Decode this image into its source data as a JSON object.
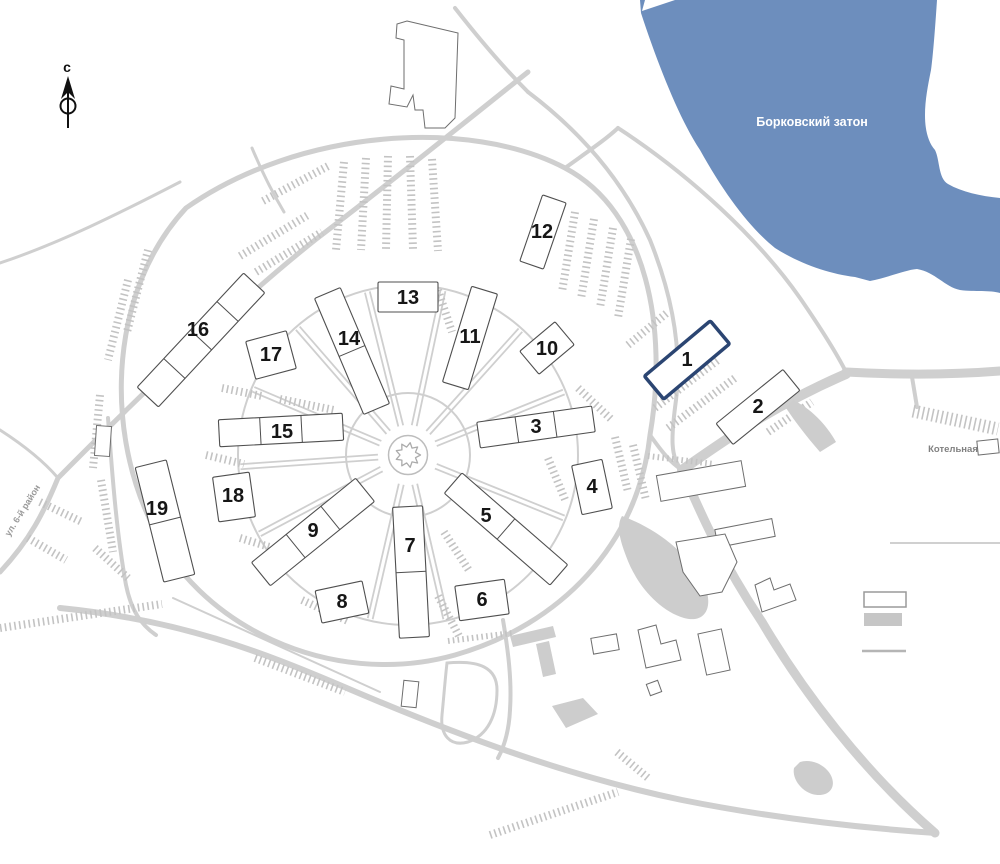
{
  "map": {
    "colors": {
      "water": "#6d8ebd",
      "road": "#cfcfcf",
      "comb": "#c3c3c3",
      "area": "#cdcdcd",
      "outline": "#6e6e6e",
      "highlight": "#2b4572",
      "number": "#161616"
    },
    "water": {
      "label": "Борковский затон",
      "path": "M 640,0 L 937,0 C 935,30 933,55 931,70 C 928,85 925,100 925,115 C 925,130 928,142 935,150 C 940,160 938,178 948,184 C 962,192 980,196 1000,198 L 1000,293 C 990,290 975,292 960,290 C 945,287 935,272 917,269 C 905,270 890,277 870,281 L 855,277 C 830,274 800,264 775,248 C 750,228 725,195 700,150 C 680,120 658,65 641,13 Z",
      "notch": "645,0 675,0 642,11"
    },
    "compass": {
      "letter": "с"
    },
    "labels": {
      "boiler": {
        "text": "Котельная"
      },
      "street": {
        "text": "ул. 6-й район"
      }
    },
    "roads": [
      {
        "d": "M 186,208 C 300,128 470,118 565,168 C 648,212 668,330 650,435 C 638,545 560,625 455,655 C 330,690 195,625 150,520 C 105,425 110,290 186,208 Z",
        "w": 5
      },
      {
        "d": "M 0,572 C 30,540 44,512 58,478 C 150,385 240,300 315,240 C 390,183 465,122 528,72",
        "w": 5
      },
      {
        "d": "M 252,148 C 262,172 272,192 284,212",
        "w": 3
      },
      {
        "d": "M 455,8 C 480,40 504,68 528,92",
        "w": 4
      },
      {
        "d": "M 528,92 C 585,135 625,185 650,240 C 672,295 682,350 676,400 C 671,437 670,458 682,470",
        "w": 4
      },
      {
        "d": "M 618,128 C 690,175 758,238 800,298 C 822,330 836,352 846,372",
        "w": 4
      },
      {
        "d": "M 565,168 C 590,150 605,140 618,128",
        "w": 4
      },
      {
        "d": "M 846,372 C 900,375 950,375 1000,371",
        "w": 9
      },
      {
        "d": "M 912,377 L 917,407",
        "w": 4
      },
      {
        "d": "M 682,470 C 722,442 772,406 846,374",
        "w": 10
      },
      {
        "d": "M 682,470 C 700,512 722,562 762,622 C 802,690 862,770 935,833",
        "w": 9
      },
      {
        "d": "M 60,608 C 180,620 262,652 342,686 C 452,733 562,775 682,800 C 772,818 862,828 936,833",
        "w": 6
      },
      {
        "d": "M 0,430 C 28,448 46,464 58,478",
        "w": 3
      },
      {
        "d": "M 108,418 C 112,470 116,530 126,585 C 131,610 141,625 156,635",
        "w": 4
      },
      {
        "d": "M 0,263 C 60,243 120,213 180,182",
        "w": 3
      },
      {
        "d": "M 650,435 C 662,452 670,462 682,470",
        "w": 4
      },
      {
        "d": "M 503,620 C 508,650 512,680 510,710 C 509,730 505,745 498,758",
        "w": 4
      },
      {
        "d": "M 447,663 C 480,660 497,668 497,690 C 497,715 488,735 468,742 C 450,747 440,735 442,715 C 444,695 445,680 447,663 Z",
        "w": 3
      },
      {
        "d": "M 173,598 C 240,628 310,660 380,692",
        "w": 2
      }
    ],
    "rings": [
      {
        "cx": 408,
        "cy": 455,
        "r": 170,
        "w": 2
      },
      {
        "cx": 408,
        "cy": 455,
        "r": 62,
        "w": 2
      }
    ],
    "spokes": {
      "cx": 408,
      "cy": 455,
      "r0": 30,
      "r1": 168,
      "offset": 2.5,
      "angles": [
        -48,
        -78,
        -104,
        -131,
        -157,
        176,
        152,
        103,
        77,
        22,
        -22
      ]
    },
    "roundabout": {
      "cx": 408,
      "cy": 455,
      "r": 19.5,
      "teeth": 9,
      "r_out": 12.5,
      "r_in": 8
    },
    "combs": [
      [
        344,
        162,
        336,
        250
      ],
      [
        366,
        158,
        361,
        250
      ],
      [
        388,
        156,
        386,
        249
      ],
      [
        410,
        156,
        413,
        249
      ],
      [
        432,
        159,
        438,
        251
      ],
      [
        575,
        212,
        562,
        292
      ],
      [
        594,
        219,
        581,
        299
      ],
      [
        613,
        228,
        600,
        308
      ],
      [
        631,
        239,
        618,
        318
      ],
      [
        628,
        345,
        668,
        312
      ],
      [
        655,
        408,
        718,
        360
      ],
      [
        668,
        428,
        735,
        378
      ],
      [
        768,
        432,
        812,
        402
      ],
      [
        913,
        411,
        998,
        429,
        13
      ],
      [
        128,
        280,
        108,
        360
      ],
      [
        148,
        250,
        127,
        332
      ],
      [
        100,
        395,
        93,
        468
      ],
      [
        101,
        480,
        113,
        552
      ],
      [
        0,
        628,
        162,
        604
      ],
      [
        95,
        548,
        128,
        578
      ],
      [
        448,
        641,
        512,
        633,
        6
      ],
      [
        255,
        658,
        345,
        692
      ],
      [
        490,
        835,
        618,
        792
      ],
      [
        222,
        388,
        262,
        396
      ],
      [
        280,
        399,
        334,
        410
      ],
      [
        240,
        256,
        308,
        215
      ],
      [
        256,
        272,
        322,
        232
      ],
      [
        263,
        201,
        330,
        165
      ],
      [
        240,
        538,
        286,
        552
      ],
      [
        302,
        600,
        350,
        622
      ],
      [
        444,
        532,
        470,
        572
      ],
      [
        438,
        596,
        460,
        638
      ],
      [
        548,
        458,
        566,
        502
      ],
      [
        578,
        388,
        612,
        420
      ],
      [
        615,
        437,
        628,
        492
      ],
      [
        633,
        445,
        646,
        500
      ],
      [
        648,
        456,
        714,
        464,
        6
      ],
      [
        617,
        752,
        648,
        778
      ],
      [
        40,
        502,
        82,
        522
      ],
      [
        28,
        538,
        66,
        560
      ],
      [
        206,
        455,
        244,
        464
      ],
      [
        438,
        290,
        452,
        332
      ]
    ],
    "gray_shapes": [
      {
        "d": "M 622,516 C 655,528 688,552 704,584 C 714,606 706,624 684,618 C 658,610 636,584 626,556 C 620,540 616,526 622,516 Z"
      },
      {
        "d": "M 510,636 L 553,626 L 556,637 L 513,647 Z"
      },
      {
        "d": "M 536,644 L 549,641 L 556,674 L 543,677 Z"
      },
      {
        "d": "M 552,706 L 583,698 L 598,714 L 566,728 Z"
      },
      {
        "d": "M 800,762 C 812,758 828,766 832,778 C 836,790 826,798 812,794 C 800,790 792,778 794,768 Z"
      },
      {
        "d": "M 793,400 C 810,408 826,424 836,442 L 820,452 C 806,436 794,420 786,408 Z"
      }
    ],
    "outline_buildings": [
      {
        "type": "poly",
        "points": "407,21 458,33 455,118 445,128 425,128 423,110 415,110 413,95 407,107 389,104 391,86 404,89 404,40 396,38 397,24"
      },
      {
        "type": "rect",
        "cx": 701,
        "cy": 481,
        "w": 86,
        "h": 26,
        "rot": -10
      },
      {
        "type": "rect",
        "cx": 745,
        "cy": 533,
        "w": 58,
        "h": 18,
        "rot": -11
      },
      {
        "type": "poly",
        "points": "676,542 725,534 737,562 722,592 700,596 683,572"
      },
      {
        "type": "poly",
        "points": "755,585 770,578 774,590 790,584 796,600 762,612"
      },
      {
        "type": "rect",
        "cx": 605,
        "cy": 644,
        "w": 26,
        "h": 16,
        "rot": -10
      },
      {
        "type": "poly",
        "points": "638,630 656,625 661,644 676,640 681,660 646,668"
      },
      {
        "type": "rect",
        "cx": 714,
        "cy": 652,
        "w": 24,
        "h": 42,
        "rot": -12
      },
      {
        "type": "rect",
        "cx": 654,
        "cy": 688,
        "w": 12,
        "h": 12,
        "rot": -20
      },
      {
        "type": "rect",
        "cx": 410,
        "cy": 694,
        "w": 15,
        "h": 26,
        "rot": 6
      },
      {
        "type": "rect",
        "cx": 103,
        "cy": 441,
        "w": 15,
        "h": 30,
        "rot": 4
      },
      {
        "type": "rect",
        "cx": 988,
        "cy": 447,
        "w": 21,
        "h": 14,
        "rot": -6
      }
    ],
    "buildings": [
      {
        "num": "1",
        "cx": 687,
        "cy": 360,
        "w": 86,
        "h": 30,
        "rot": -40,
        "segs": 1,
        "hl": true,
        "nx": 687,
        "ny": 360
      },
      {
        "num": "2",
        "cx": 758,
        "cy": 407,
        "w": 86,
        "h": 27,
        "rot": -39,
        "segs": 1,
        "nx": 758,
        "ny": 407
      },
      {
        "num": "3",
        "cx": 536,
        "cy": 427,
        "w": 116,
        "h": 26,
        "rot": -8,
        "segs": 3,
        "nx": 536,
        "ny": 427
      },
      {
        "num": "4",
        "cx": 592,
        "cy": 487,
        "w": 31,
        "h": 50,
        "rot": -12,
        "segs": 1,
        "nx": 592,
        "ny": 487
      },
      {
        "num": "5",
        "cx": 506,
        "cy": 529,
        "w": 140,
        "h": 27,
        "rot": 41,
        "segs": 2,
        "nx": 486,
        "ny": 516
      },
      {
        "num": "6",
        "cx": 482,
        "cy": 600,
        "w": 50,
        "h": 35,
        "rot": -8,
        "segs": 1,
        "nx": 482,
        "ny": 600
      },
      {
        "num": "7",
        "cx": 411,
        "cy": 572,
        "w": 30,
        "h": 131,
        "rot": -3,
        "segs": 2,
        "nx": 410,
        "ny": 546
      },
      {
        "num": "8",
        "cx": 342,
        "cy": 602,
        "w": 48,
        "h": 33,
        "rot": -12,
        "segs": 1,
        "nx": 342,
        "ny": 602
      },
      {
        "num": "9",
        "cx": 313,
        "cy": 532,
        "w": 134,
        "h": 30,
        "rot": -39,
        "segs": 3,
        "nx": 313,
        "ny": 531
      },
      {
        "num": "10",
        "cx": 547,
        "cy": 348,
        "w": 46,
        "h": 30,
        "rot": -40,
        "segs": 1,
        "nx": 547,
        "ny": 349
      },
      {
        "num": "11",
        "cx": 470,
        "cy": 338,
        "w": 100,
        "h": 27,
        "rot": -73,
        "segs": 1,
        "nx": 470,
        "ny": 337
      },
      {
        "num": "12",
        "cx": 543,
        "cy": 232,
        "w": 70,
        "h": 25,
        "rot": -71,
        "segs": 1,
        "nx": 542,
        "ny": 232
      },
      {
        "num": "13",
        "cx": 408,
        "cy": 297,
        "w": 60,
        "h": 30,
        "rot": 0,
        "segs": 1,
        "nx": 408,
        "ny": 298
      },
      {
        "num": "14",
        "cx": 352,
        "cy": 351,
        "w": 126,
        "h": 28,
        "rot": 67,
        "segs": 2,
        "nx": 349,
        "ny": 339
      },
      {
        "num": "15",
        "cx": 281,
        "cy": 430,
        "w": 124,
        "h": 27,
        "rot": -3,
        "segs": 3,
        "nx": 282,
        "ny": 432
      },
      {
        "num": "16",
        "cx": 201,
        "cy": 340,
        "w": 156,
        "h": 29,
        "rot": -47,
        "segs": 4,
        "nx": 198,
        "ny": 330
      },
      {
        "num": "17",
        "cx": 271,
        "cy": 355,
        "w": 42,
        "h": 39,
        "rot": -15,
        "segs": 1,
        "nx": 271,
        "ny": 355
      },
      {
        "num": "18",
        "cx": 234,
        "cy": 497,
        "w": 37,
        "h": 45,
        "rot": -8,
        "segs": 1,
        "nx": 233,
        "ny": 496
      },
      {
        "num": "19",
        "cx": 165,
        "cy": 521,
        "w": 118,
        "h": 32,
        "rot": 76,
        "segs": 2,
        "nx": 157,
        "ny": 509
      }
    ]
  }
}
